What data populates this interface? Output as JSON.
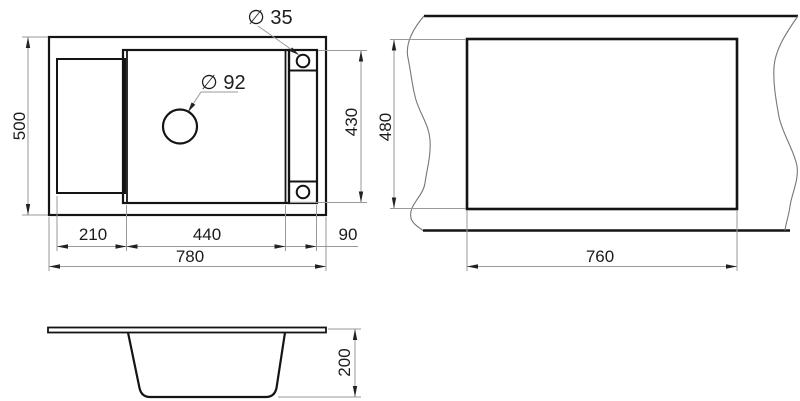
{
  "drawing": {
    "type": "technical-dimension-drawing",
    "subject": "kitchen sink installation drawing",
    "colors": {
      "background": "#ffffff",
      "outline": "#141414",
      "dimension_lines": "#999999",
      "text": "#1c1c1c"
    },
    "views": {
      "top": {
        "dims": {
          "overall_depth": "500",
          "overall_width": "780",
          "drainboard_width": "210",
          "bowl_width": "440",
          "faucet_deck_width": "90",
          "bowl_depth": "430",
          "drain_hole_diameter": "∅ 92",
          "faucet_hole_diameter": "∅ 35"
        }
      },
      "cutout": {
        "dims": {
          "cutout_width": "760",
          "cutout_height": "480"
        }
      },
      "side": {
        "dims": {
          "bowl_height": "200"
        }
      }
    }
  }
}
